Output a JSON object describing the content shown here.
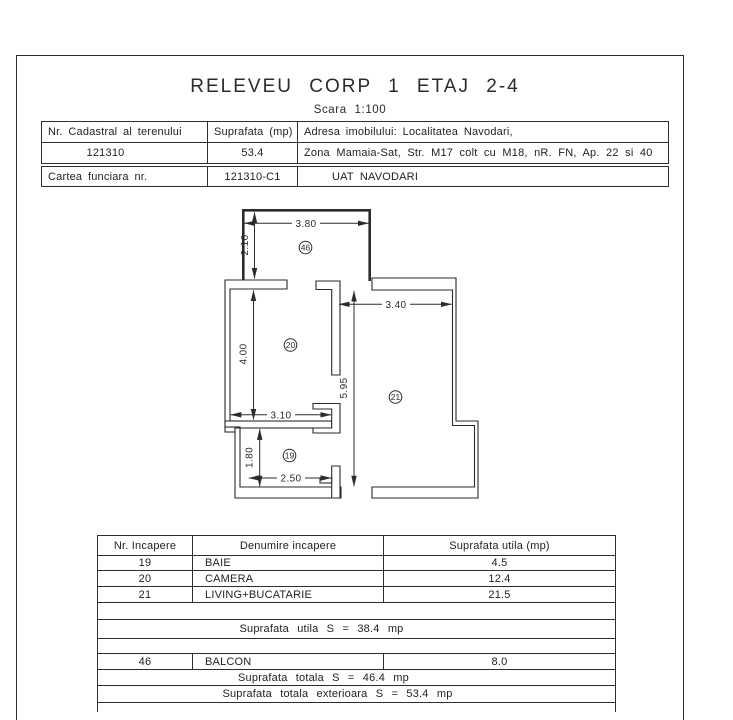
{
  "page": {
    "title": "RELEVEU CORP 1 ETAJ 2-4",
    "scale_label": "Scara 1:100"
  },
  "info_table": {
    "nr_cadastral_label": "Nr. Cadastral al terenului",
    "suprafata_label": "Suprafata (mp)",
    "adresa_label": "Adresa imobilului: Localitatea Navodari,",
    "nr_cadastral_value": "121310",
    "suprafata_value": "53.4",
    "adresa_value": "Zona Mamaia-Sat, Str. M17 colt cu M18, nR. FN, Ap. 22 si 40",
    "carte_funciara_label": "Cartea funciara nr.",
    "carte_funciara_value": "121310-C1",
    "uat_value": "UAT NAVODARI"
  },
  "plan": {
    "rooms": {
      "balcon": "46",
      "camera": "20",
      "living": "21",
      "baie": "19"
    },
    "dims": {
      "balcony_width": "3.80",
      "balcony_depth": "2.10",
      "camera_height": "4.00",
      "camera_width": "3.10",
      "baie_height": "1.80",
      "baie_width": "2.50",
      "living_height": "5.95",
      "living_width": "3.40"
    }
  },
  "areas_table": {
    "headers": {
      "nr": "Nr. Incapere",
      "name": "Denumire incapere",
      "area": "Suprafata utila (mp)"
    },
    "rows": [
      {
        "nr": "19",
        "name": "BAIE",
        "area": "4.5"
      },
      {
        "nr": "20",
        "name": "CAMERA",
        "area": "12.4"
      },
      {
        "nr": "21",
        "name": "LIVING+BUCATARIE",
        "area": "21.5"
      }
    ],
    "useful_total": "Suprafata utila S = 38.4 mp",
    "balcony_row": {
      "nr": "46",
      "name": "BALCON",
      "area": "8.0"
    },
    "grand_total": "Suprafata totala S = 46.4 mp",
    "exterior_total": "Suprafata totala exterioara S = 53.4 mp"
  }
}
